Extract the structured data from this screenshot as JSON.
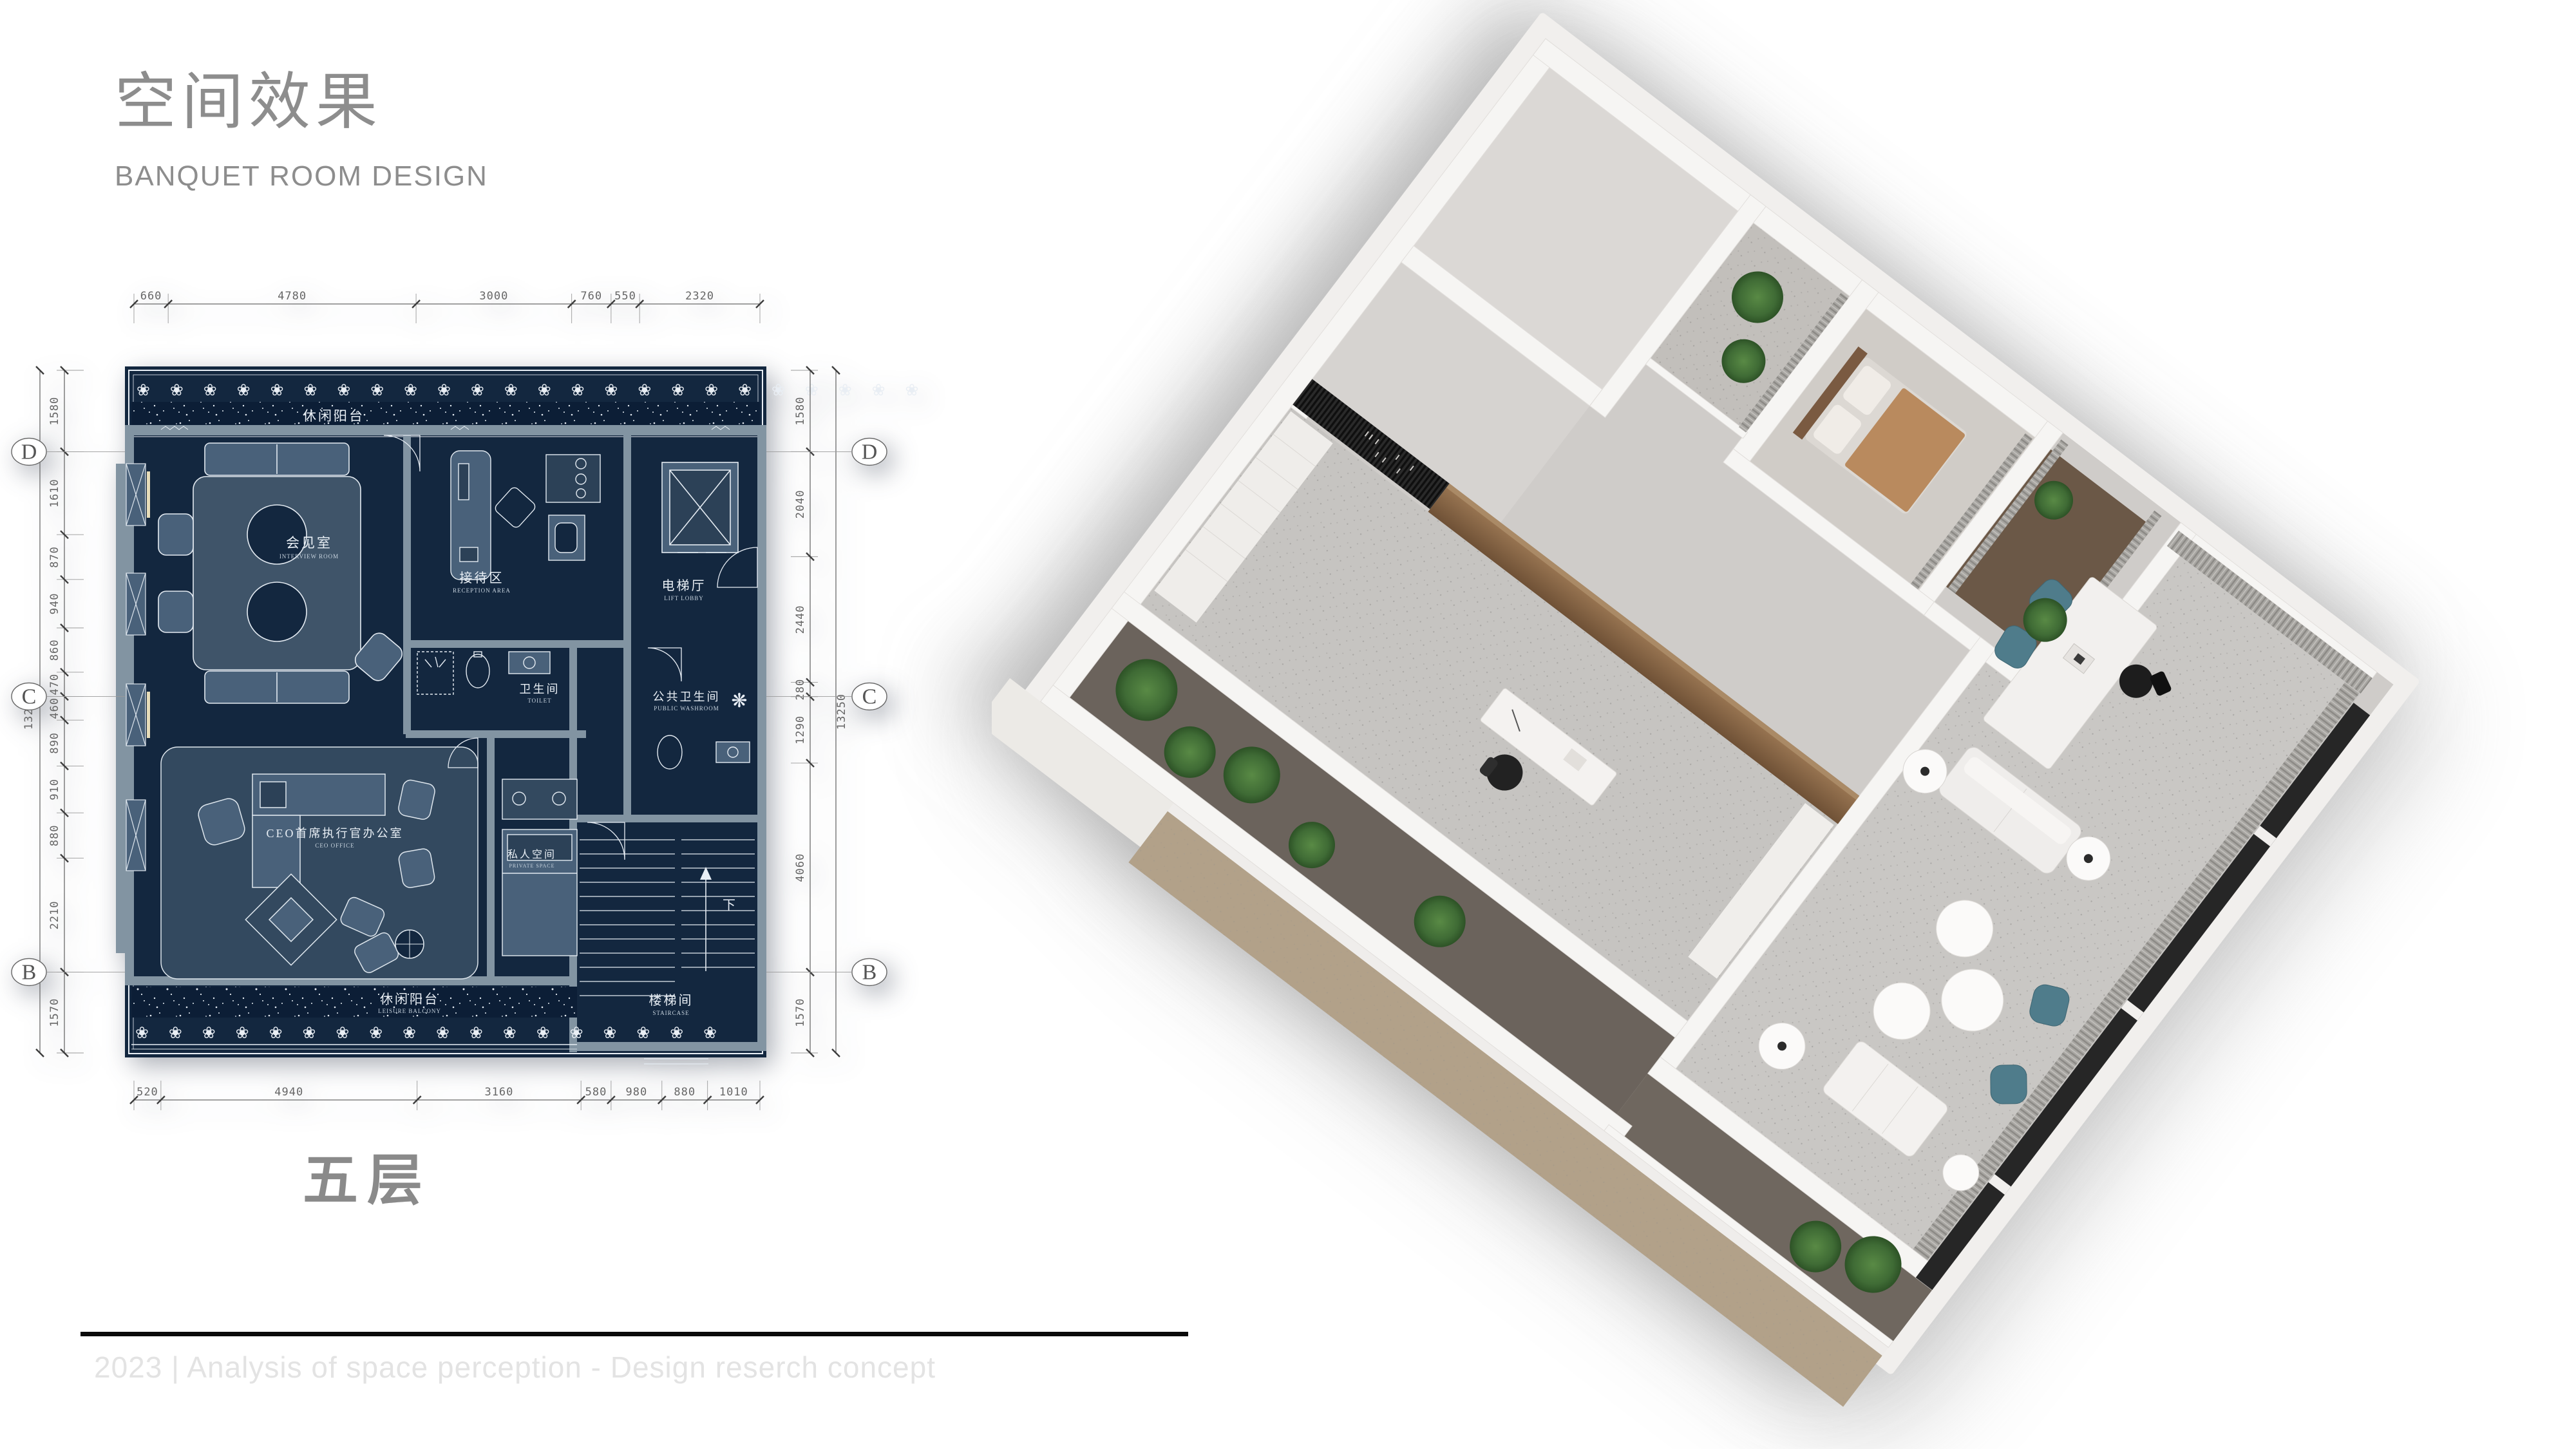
{
  "page": {
    "background": "#ffffff"
  },
  "header": {
    "title_zh": "空间效果",
    "subtitle_en": "BANQUET ROOM DESIGN"
  },
  "plan": {
    "floor_label": "五层",
    "ornament_glyph": "❀",
    "dimensions": {
      "top": [
        "660",
        "4780",
        "3000",
        "760",
        "550",
        "2320"
      ],
      "bottom": [
        "520",
        "4940",
        "3160",
        "580",
        "980",
        "880",
        "1010"
      ],
      "left": [
        "1580",
        "1610",
        "870",
        "940",
        "860",
        "470",
        "460",
        "890",
        "910",
        "880",
        "2210",
        "1570"
      ],
      "right": [
        "1580",
        "2040",
        "2440",
        "280",
        "1290",
        "4060",
        "1570"
      ],
      "left_total": "13250",
      "right_total": "13250"
    },
    "grid_markers": [
      "D",
      "C",
      "B"
    ],
    "rooms": [
      {
        "id": "leisure-balcony-top",
        "zh": "休闲阳台",
        "en": "LEISURE BALCONY"
      },
      {
        "id": "interview-room",
        "zh": "会见室",
        "en": "INTERVIEW ROOM"
      },
      {
        "id": "reception-area",
        "zh": "接待区",
        "en": "RECEPTION AREA"
      },
      {
        "id": "lift-lobby",
        "zh": "电梯厅",
        "en": "LIFT LOBBY"
      },
      {
        "id": "toilet",
        "zh": "卫生间",
        "en": "TOILET"
      },
      {
        "id": "public-washroom",
        "zh": "公共卫生间",
        "en": "PUBLIC WASHROOM"
      },
      {
        "id": "ceo-office",
        "zh": "CEO首席执行官办公室",
        "en": "CEO OFFICE"
      },
      {
        "id": "private-space",
        "zh": "私人空间",
        "en": "PRIVATE SPACE"
      },
      {
        "id": "staircase",
        "zh": "楼梯间",
        "en": "STAIRCASE"
      },
      {
        "id": "leisure-balcony-bottom",
        "zh": "休闲阳台",
        "en": "LEISURE BALCONY"
      }
    ],
    "stair_direction_label": "下",
    "colors": {
      "plan_navy": "#13273f",
      "plan_slate": "#4e6378",
      "plan_wall": "#8294a2",
      "line_white": "#e8eef5"
    }
  },
  "render": {
    "colors": {
      "wall": "#f6f5f3",
      "floor": "#c8c6c3",
      "wood": "#8a6a4b",
      "louver": "#181818",
      "curtain": "#a09e9a",
      "teal_chair": "#4f7c8b",
      "plant": "#3f6b35",
      "balcony_floor": "#6b635c",
      "deck_tan": "#b2a189"
    }
  },
  "footer": {
    "line_color": "#000000",
    "text": "2023 | Analysis of space perception - Design reserch concept"
  }
}
